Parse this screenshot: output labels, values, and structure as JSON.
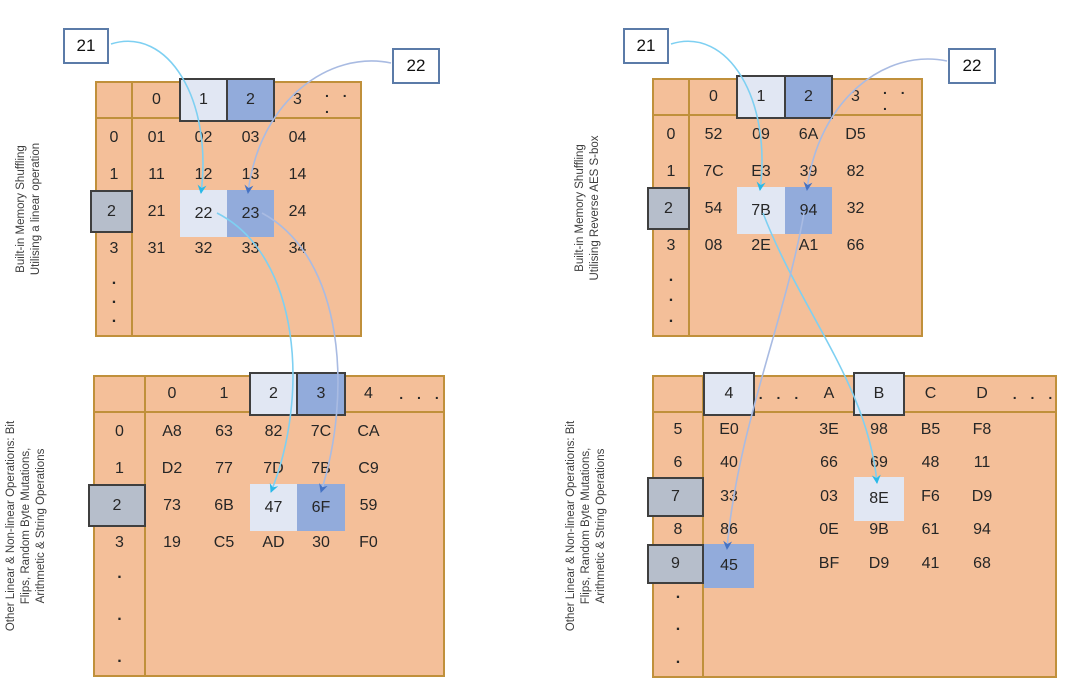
{
  "palette": {
    "table-fill": "#F4BF99",
    "table-border": "#C0903B",
    "hl-light": "#E1E7F3",
    "hl-blue": "#92ABDB",
    "gray-fill": "#B6BECB",
    "dark-border": "#3F3F3F",
    "text": "#262626",
    "callout-border": "#5B7BA8",
    "arrow-cyan": "#29B9E8",
    "arrow-blue": "#4472C4",
    "arrow-cyan-stroke": "#7ED0F2",
    "arrow-blue-stroke": "#A9BBE2"
  },
  "panels": [
    {
      "name": "linear-operation",
      "callouts": [
        "21",
        "22"
      ],
      "top_table": {
        "label_lines": [
          "Built-in Memory Shuffling",
          "Utilising a linear operation"
        ],
        "headers": [
          {
            "t": "0"
          },
          {
            "t": "1",
            "s": "light"
          },
          {
            "t": "2",
            "s": "blue"
          },
          {
            "t": "3"
          },
          {
            "t": ". . .",
            "s": "dots"
          }
        ],
        "rows": [
          {
            "label": {
              "t": "0"
            },
            "cells": [
              {
                "t": "01"
              },
              {
                "t": "02"
              },
              {
                "t": "03"
              },
              {
                "t": "04"
              },
              {
                "t": ""
              }
            ]
          },
          {
            "label": {
              "t": "1"
            },
            "cells": [
              {
                "t": "11"
              },
              {
                "t": "12"
              },
              {
                "t": "13"
              },
              {
                "t": "14"
              },
              {
                "t": ""
              }
            ]
          },
          {
            "label": {
              "t": "2",
              "s": "gray"
            },
            "cells": [
              {
                "t": "21"
              },
              {
                "t": "22",
                "s": "light"
              },
              {
                "t": "23",
                "s": "blue"
              },
              {
                "t": "24"
              },
              {
                "t": ""
              }
            ]
          },
          {
            "label": {
              "t": "3"
            },
            "cells": [
              {
                "t": "31"
              },
              {
                "t": "32"
              },
              {
                "t": "33"
              },
              {
                "t": "34"
              },
              {
                "t": ""
              }
            ]
          }
        ],
        "trail_dots": [
          ".",
          ".",
          "."
        ]
      },
      "bottom_table": {
        "label_lines": [
          "Other Linear & Non-linear Operations: Bit",
          "Flips, Random Byte Mutations,",
          "Arithmetic & String Operations"
        ],
        "headers": [
          {
            "t": "0"
          },
          {
            "t": "1"
          },
          {
            "t": "2",
            "s": "light"
          },
          {
            "t": "3",
            "s": "blue"
          },
          {
            "t": "4"
          },
          {
            "t": ". . .",
            "s": "dots"
          }
        ],
        "rows": [
          {
            "label": {
              "t": "0"
            },
            "cells": [
              {
                "t": "A8"
              },
              {
                "t": "63"
              },
              {
                "t": "82"
              },
              {
                "t": "7C"
              },
              {
                "t": "CA"
              },
              {
                "t": ""
              }
            ]
          },
          {
            "label": {
              "t": "1"
            },
            "cells": [
              {
                "t": "D2"
              },
              {
                "t": "77"
              },
              {
                "t": "7D"
              },
              {
                "t": "7B"
              },
              {
                "t": "C9"
              },
              {
                "t": ""
              }
            ]
          },
          {
            "label": {
              "t": "2",
              "s": "gray"
            },
            "cells": [
              {
                "t": "73"
              },
              {
                "t": "6B"
              },
              {
                "t": "47",
                "s": "light"
              },
              {
                "t": "6F",
                "s": "blue"
              },
              {
                "t": "59"
              },
              {
                "t": ""
              }
            ]
          },
          {
            "label": {
              "t": "3"
            },
            "cells": [
              {
                "t": "19"
              },
              {
                "t": "C5"
              },
              {
                "t": "AD"
              },
              {
                "t": "30"
              },
              {
                "t": "F0"
              },
              {
                "t": ""
              }
            ]
          }
        ],
        "trail_dots": [
          ".",
          ".",
          "."
        ]
      }
    },
    {
      "name": "reverse-aes-sbox",
      "callouts": [
        "21",
        "22"
      ],
      "top_table": {
        "label_lines": [
          "Built-in Memory Shuffling",
          "Utilising  Reverse AES S-box"
        ],
        "headers": [
          {
            "t": "0"
          },
          {
            "t": "1",
            "s": "light"
          },
          {
            "t": "2",
            "s": "blue"
          },
          {
            "t": "3"
          },
          {
            "t": ". . .",
            "s": "dots"
          }
        ],
        "rows": [
          {
            "label": {
              "t": "0"
            },
            "cells": [
              {
                "t": "52"
              },
              {
                "t": "09"
              },
              {
                "t": "6A"
              },
              {
                "t": "D5"
              },
              {
                "t": ""
              }
            ]
          },
          {
            "label": {
              "t": "1"
            },
            "cells": [
              {
                "t": "7C"
              },
              {
                "t": "E3"
              },
              {
                "t": "39"
              },
              {
                "t": "82"
              },
              {
                "t": ""
              }
            ]
          },
          {
            "label": {
              "t": "2",
              "s": "gray"
            },
            "cells": [
              {
                "t": "54"
              },
              {
                "t": "7B",
                "s": "light"
              },
              {
                "t": "94",
                "s": "blue"
              },
              {
                "t": "32"
              },
              {
                "t": ""
              }
            ]
          },
          {
            "label": {
              "t": "3"
            },
            "cells": [
              {
                "t": "08"
              },
              {
                "t": "2E"
              },
              {
                "t": "A1"
              },
              {
                "t": "66"
              },
              {
                "t": ""
              }
            ]
          }
        ],
        "trail_dots": [
          ".",
          ".",
          "."
        ]
      },
      "bottom_table": {
        "label_lines": [
          "Other Linear & Non-linear Operations: Bit",
          "Flips, Random Byte Mutations,",
          "Arithmetic & String Operations"
        ],
        "headers": [
          {
            "t": "4",
            "s": "light"
          },
          {
            "t": ". . .",
            "s": "dots"
          },
          {
            "t": "A"
          },
          {
            "t": "B",
            "s": "light"
          },
          {
            "t": "C"
          },
          {
            "t": "D"
          },
          {
            "t": ". . .",
            "s": "dots"
          }
        ],
        "rows": [
          {
            "label": {
              "t": "5"
            },
            "cells": [
              {
                "t": "E0"
              },
              {
                "t": ""
              },
              {
                "t": "3E"
              },
              {
                "t": "98"
              },
              {
                "t": "B5"
              },
              {
                "t": "F8"
              },
              {
                "t": ""
              }
            ]
          },
          {
            "label": {
              "t": "6"
            },
            "cells": [
              {
                "t": "40"
              },
              {
                "t": ""
              },
              {
                "t": "66"
              },
              {
                "t": "69"
              },
              {
                "t": "48"
              },
              {
                "t": "11"
              },
              {
                "t": ""
              }
            ]
          },
          {
            "label": {
              "t": "7",
              "s": "gray"
            },
            "cells": [
              {
                "t": "33"
              },
              {
                "t": ""
              },
              {
                "t": "03"
              },
              {
                "t": "8E",
                "s": "light"
              },
              {
                "t": "F6"
              },
              {
                "t": "D9"
              },
              {
                "t": ""
              }
            ]
          },
          {
            "label": {
              "t": "8"
            },
            "cells": [
              {
                "t": "86"
              },
              {
                "t": ""
              },
              {
                "t": "0E"
              },
              {
                "t": "9B"
              },
              {
                "t": "61"
              },
              {
                "t": "94"
              },
              {
                "t": ""
              }
            ]
          },
          {
            "label": {
              "t": "9",
              "s": "gray"
            },
            "cells": [
              {
                "t": "45",
                "s": "blue"
              },
              {
                "t": ""
              },
              {
                "t": "BF"
              },
              {
                "t": "D9"
              },
              {
                "t": "41"
              },
              {
                "t": "68"
              },
              {
                "t": ""
              }
            ]
          }
        ],
        "trail_dots": [
          ".",
          ".",
          "."
        ]
      }
    }
  ],
  "arrows": [
    {
      "panel": "left",
      "from": "callout-21",
      "to": "cell-22",
      "color": "cyan"
    },
    {
      "panel": "left",
      "from": "callout-22",
      "to": "cell-23",
      "color": "blue"
    },
    {
      "panel": "left",
      "from": "cell-22",
      "to": "cell-47",
      "color": "cyan"
    },
    {
      "panel": "left",
      "from": "cell-23",
      "to": "cell-6F",
      "color": "blue"
    },
    {
      "panel": "right",
      "from": "callout-21",
      "to": "cell-7B",
      "color": "cyan"
    },
    {
      "panel": "right",
      "from": "callout-22",
      "to": "cell-94",
      "color": "blue"
    },
    {
      "panel": "right",
      "from": "cell-7B",
      "to": "cell-8E",
      "color": "cyan"
    },
    {
      "panel": "right",
      "from": "cell-94",
      "to": "cell-45",
      "color": "blue"
    }
  ]
}
